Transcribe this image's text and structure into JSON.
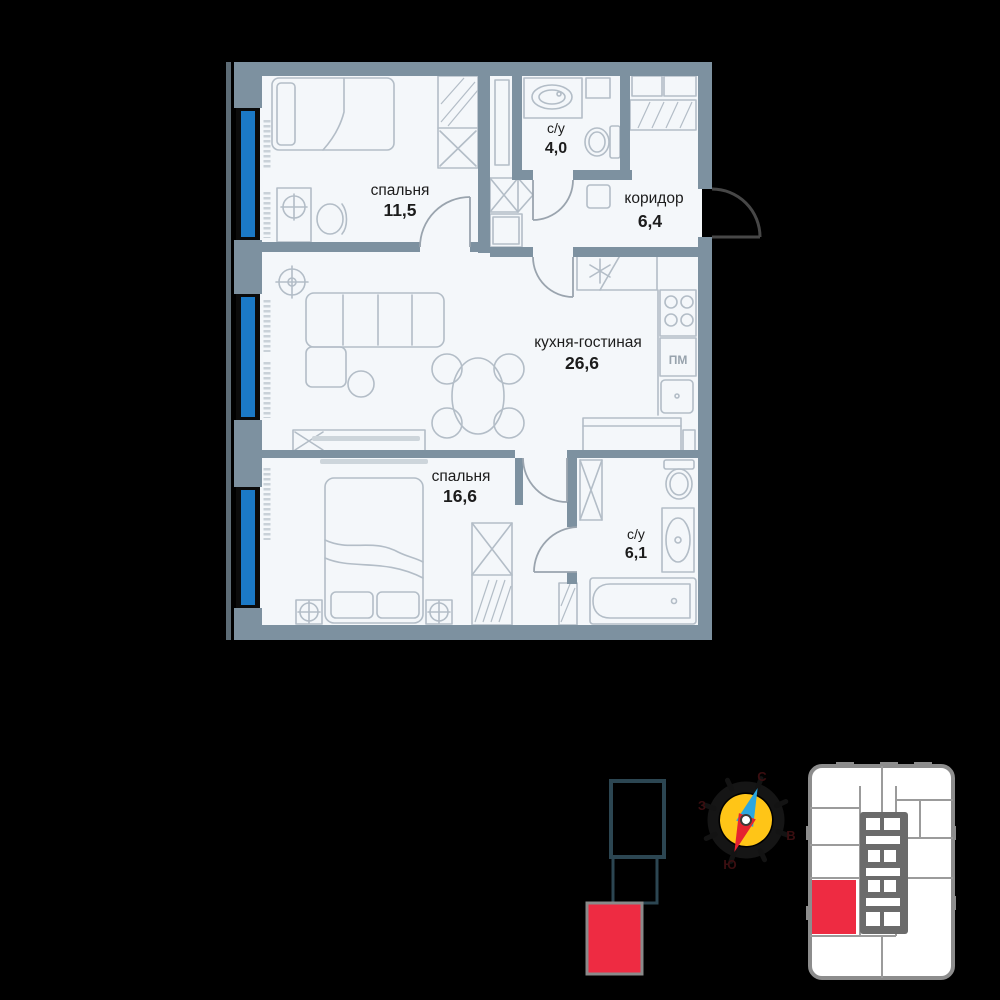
{
  "colors": {
    "background": "#000000",
    "floor": "#f4f7fa",
    "wall": "#7d91a0",
    "furniture_line": "#b3bdc7",
    "window_blue": "#1b79c6",
    "accent_red": "#ee2b42",
    "section_outline": "#2c4652",
    "compass_yellow": "#ffc517",
    "needle_blue": "#2ba7e0",
    "needle_red": "#e52330",
    "text_dark": "#1c1c1c"
  },
  "rooms": [
    {
      "name": "спальня",
      "area": "11,5"
    },
    {
      "name": "с/у",
      "area": "4,0"
    },
    {
      "name": "коридор",
      "area": "6,4"
    },
    {
      "name": "кухня-гостиная",
      "area": "26,6"
    },
    {
      "name": "спальня",
      "area": "16,6"
    },
    {
      "name": "с/у",
      "area": "6,1"
    }
  ],
  "labels": {
    "dishwasher": "ПМ"
  },
  "compass": {
    "north": "С",
    "east": "В",
    "south": "Ю",
    "west": "З"
  }
}
